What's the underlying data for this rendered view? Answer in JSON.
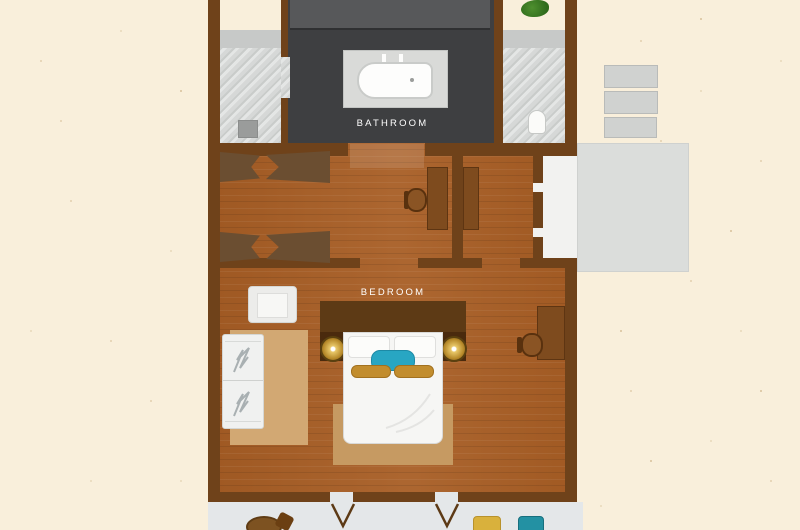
{
  "plan": {
    "labels": {
      "bathroom": "BATHROOM",
      "bedroom": "BEDROOM"
    },
    "rooms": [
      {
        "name": "bathroom",
        "floor": "dark-slate",
        "fixtures": [
          "bathtub",
          "bath-taps",
          "vanity-counter",
          "shower-room",
          "shower-stool",
          "toilet-room",
          "toilet",
          "potted-plant"
        ]
      },
      {
        "name": "dressing-area",
        "floor": "wood",
        "furniture": [
          "bench-pair-top",
          "bench-pair-bottom",
          "desk",
          "desk-chair",
          "wardrobe-counter"
        ]
      },
      {
        "name": "bedroom",
        "floor": "wood",
        "furniture": [
          "double-bed",
          "headboard",
          "nightstand-left",
          "nightstand-right",
          "bedside-lamp-left",
          "bedside-lamp-right",
          "white-pillows",
          "teal-cushion",
          "gold-bolsters",
          "foot-rug",
          "armchair",
          "daybed",
          "floor-mat",
          "desk",
          "desk-chair"
        ]
      }
    ],
    "outdoor": [
      "terrace-steps",
      "terrace-platform",
      "side-walkway",
      "bottom-deck",
      "deck-table",
      "deck-chair",
      "sun-cushion-gold",
      "sun-cushion-teal",
      "door-swing-left",
      "door-swing-right"
    ],
    "colors": {
      "background": "#f9efdb",
      "wall": "#6f421a",
      "wood_floor": "#a85e25",
      "bathroom_floor": "#3e3f41",
      "marble": "#d6d8d7",
      "deck": "#e4e7e9",
      "accent_teal": "#28a6c3",
      "accent_gold": "#c28d2e",
      "rug": "#c69a62",
      "label_text": "#ffffff"
    }
  }
}
